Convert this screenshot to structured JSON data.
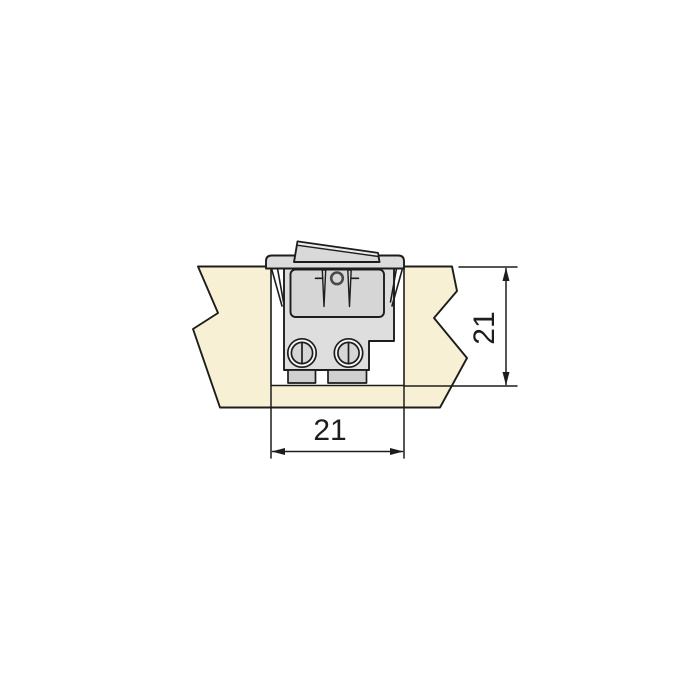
{
  "diagram": {
    "labels": {
      "cutout_width": "21",
      "cutout_depth": "21"
    },
    "colors": {
      "background": "#ffffff",
      "outline": "#1d1d1b",
      "dimension": "#1d1d1b",
      "panel": "#f8f0d4",
      "cutout": "#ffffff",
      "switch_body": "#dedede",
      "switch_face": "#d6d6d6",
      "bezel": "#dcdcdc",
      "rocker": "#d9d9d9",
      "rocker_edge": "#ececec",
      "terminal_tab": "#cfcfcf",
      "screw_ring": "#f6f6f6",
      "pivot_ring": "#4a4a4a"
    }
  }
}
